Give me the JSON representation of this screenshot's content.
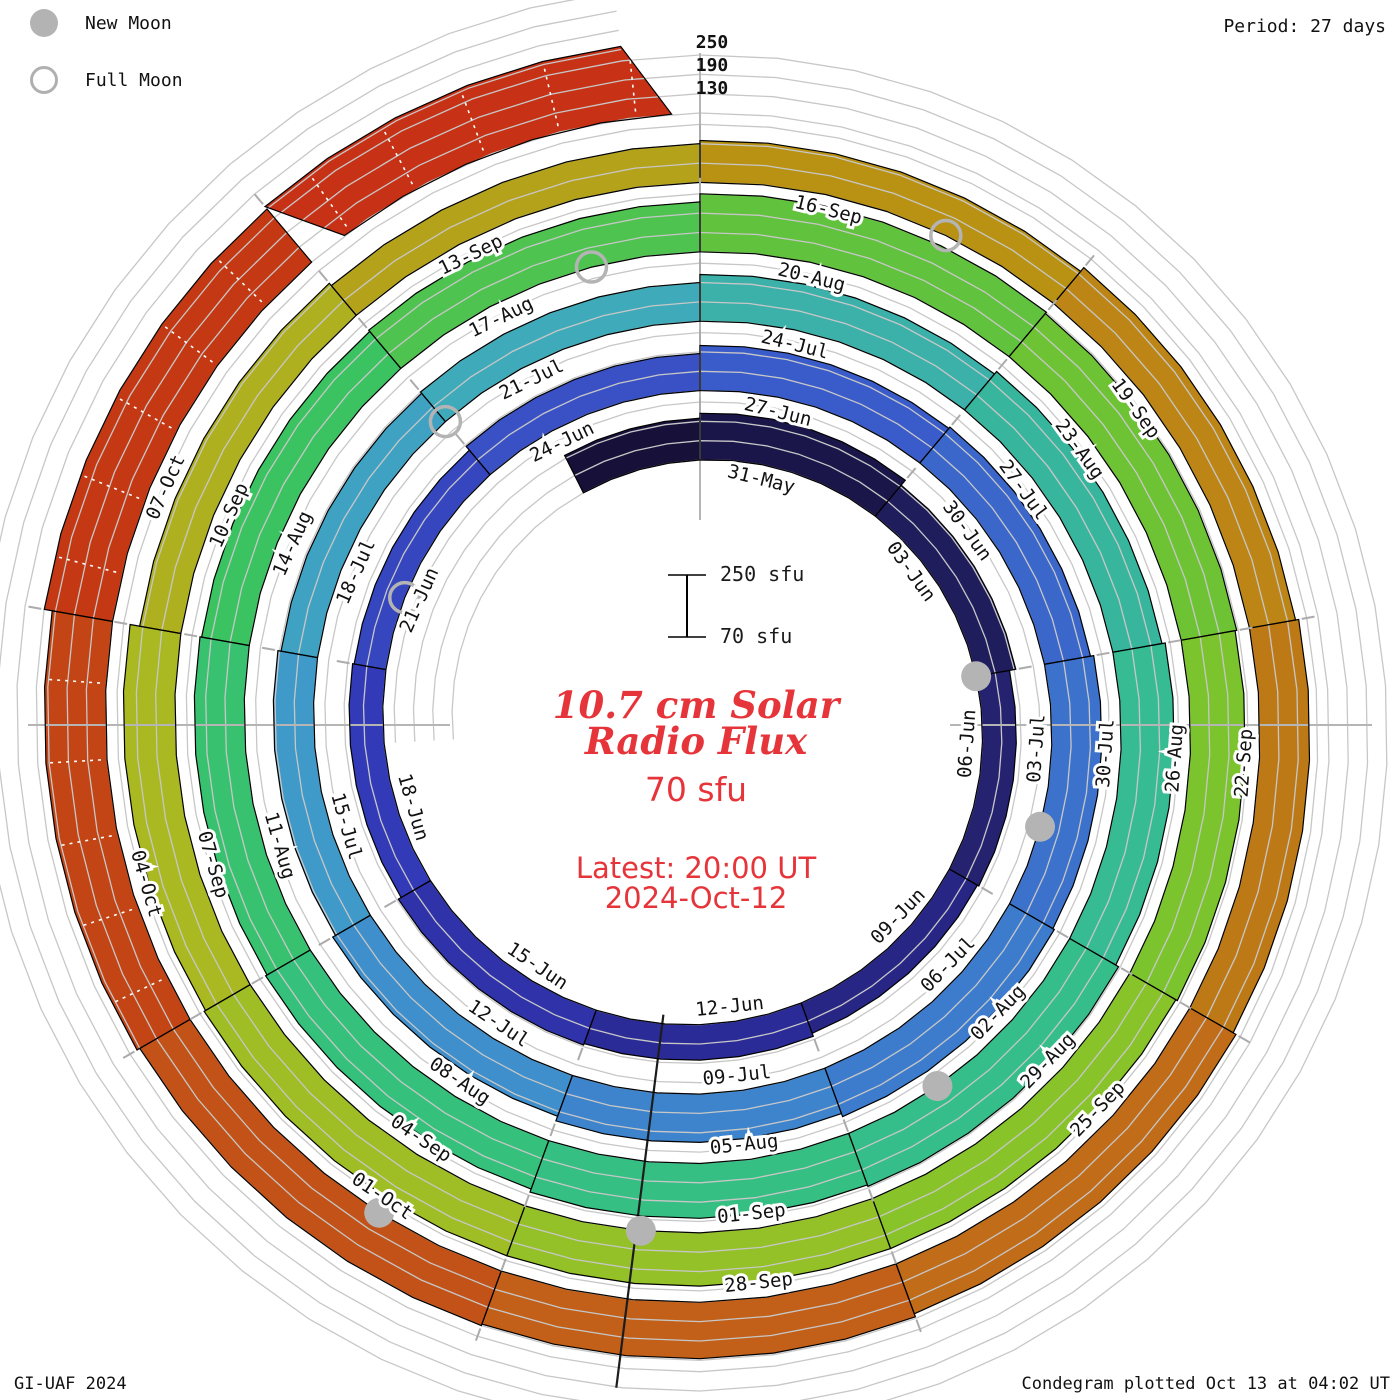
{
  "legend": {
    "items": [
      {
        "id": "new-moon",
        "label": "New Moon"
      },
      {
        "id": "full-moon",
        "label": "Full Moon"
      }
    ]
  },
  "period_label": "Period: 27 days",
  "footer": {
    "left": "GI-UAF 2024",
    "right": "Condegram plotted Oct 13 at 04:02 UT"
  },
  "center_text": {
    "title_line1": "10.7 cm Solar",
    "title_line2": "Radio Flux",
    "baseline_label": "70 sfu",
    "latest_line1": "Latest: 20:00 UT",
    "latest_line2": "2024-Oct-12",
    "color": "#e6353a"
  },
  "scale_bar": {
    "top_label": "250 sfu",
    "bottom_label": "70 sfu"
  },
  "end_axis_labels": [
    "250",
    "190",
    "130"
  ],
  "chart_data": {
    "type": "spiral-condegram-bar",
    "title": "10.7 cm Solar Radio Flux",
    "flux_unit": "sfu",
    "period_days": 27,
    "start_date": "2024-05-29",
    "end_date_label": "2024-Oct-12",
    "latest_time": "20:00 UT",
    "anchor_top_date": "31-May",
    "baseline_sfu": 70,
    "grid_levels_sfu": [
      130,
      190,
      250
    ],
    "end_day": 136.8,
    "segments": [
      {
        "d": 0,
        "label": "",
        "flux": 200
      },
      {
        "d": 2,
        "label": "31-May",
        "flux": 215
      },
      {
        "d": 5,
        "label": "03-Jun",
        "flux": 195
      },
      {
        "d": 8,
        "label": "06-Jun",
        "flux": 175
      },
      {
        "d": 11,
        "label": "09-Jun",
        "flux": 170
      },
      {
        "d": 14,
        "label": "12-Jun",
        "flux": 180
      },
      {
        "d": 17,
        "label": "15-Jun",
        "flux": 185
      },
      {
        "d": 20,
        "label": "18-Jun",
        "flux": 175
      },
      {
        "d": 23,
        "label": "21-Jun",
        "flux": 170
      },
      {
        "d": 26,
        "label": "24-Jun",
        "flux": 185
      },
      {
        "d": 29,
        "label": "27-Jun",
        "flux": 210
      },
      {
        "d": 32,
        "label": "30-Jun",
        "flux": 215
      },
      {
        "d": 35,
        "label": "03-Jul",
        "flux": 225
      },
      {
        "d": 38,
        "label": "06-Jul",
        "flux": 230
      },
      {
        "d": 41,
        "label": "09-Jul",
        "flux": 220
      },
      {
        "d": 44,
        "label": "12-Jul",
        "flux": 205
      },
      {
        "d": 47,
        "label": "15-Jul",
        "flux": 195
      },
      {
        "d": 50,
        "label": "18-Jul",
        "flux": 185
      },
      {
        "d": 53,
        "label": "21-Jul",
        "flux": 190
      },
      {
        "d": 56,
        "label": "24-Jul",
        "flux": 215
      },
      {
        "d": 59,
        "label": "27-Jul",
        "flux": 225
      },
      {
        "d": 62,
        "label": "30-Jul",
        "flux": 235
      },
      {
        "d": 65,
        "label": "02-Aug",
        "flux": 245
      },
      {
        "d": 68,
        "label": "05-Aug",
        "flux": 240
      },
      {
        "d": 71,
        "label": "08-Aug",
        "flux": 230
      },
      {
        "d": 74,
        "label": "11-Aug",
        "flux": 225
      },
      {
        "d": 77,
        "label": "14-Aug",
        "flux": 220
      },
      {
        "d": 80,
        "label": "17-Aug",
        "flux": 225
      },
      {
        "d": 83,
        "label": "20-Aug",
        "flux": 250
      },
      {
        "d": 86,
        "label": "23-Aug",
        "flux": 245
      },
      {
        "d": 89,
        "label": "26-Aug",
        "flux": 240
      },
      {
        "d": 92,
        "label": "29-Aug",
        "flux": 235
      },
      {
        "d": 95,
        "label": "01-Sep",
        "flux": 235
      },
      {
        "d": 98,
        "label": "04-Sep",
        "flux": 235
      },
      {
        "d": 101,
        "label": "07-Sep",
        "flux": 230
      },
      {
        "d": 104,
        "label": "10-Sep",
        "flux": 200
      },
      {
        "d": 107,
        "label": "13-Sep",
        "flux": 190
      },
      {
        "d": 110,
        "label": "16-Sep",
        "flux": 200
      },
      {
        "d": 113,
        "label": "19-Sep",
        "flux": 215
      },
      {
        "d": 116,
        "label": "22-Sep",
        "flux": 225
      },
      {
        "d": 119,
        "label": "25-Sep",
        "flux": 235
      },
      {
        "d": 122,
        "label": "28-Sep",
        "flux": 245
      },
      {
        "d": 125,
        "label": "01-Oct",
        "flux": 250
      },
      {
        "d": 128,
        "label": "04-Oct",
        "flux": 260,
        "hatched": true
      },
      {
        "d": 131,
        "label": "07-Oct",
        "flux": 285,
        "hatched": true
      },
      {
        "d": 134,
        "label": "",
        "flux": 295,
        "hatched": true
      }
    ],
    "moons": {
      "new": [
        {
          "d": 8,
          "date": "06-Jun"
        },
        {
          "d": 37,
          "date": "05-Jul"
        },
        {
          "d": 67,
          "date": "04-Aug"
        },
        {
          "d": 97,
          "date": "03-Sep"
        },
        {
          "d": 126,
          "date": "02-Oct"
        }
      ],
      "full": [
        {
          "d": 24,
          "date": "22-Jun"
        },
        {
          "d": 53,
          "date": "21-Jul"
        },
        {
          "d": 82,
          "date": "19-Aug"
        },
        {
          "d": 112,
          "date": "18-Sep"
        }
      ]
    },
    "colormap": [
      [
        0,
        "#150f34"
      ],
      [
        8,
        "#232066"
      ],
      [
        15,
        "#2a2a94"
      ],
      [
        21,
        "#3338b6"
      ],
      [
        29,
        "#3a57c9"
      ],
      [
        36,
        "#3c70cc"
      ],
      [
        43,
        "#3e86cd"
      ],
      [
        49,
        "#3f9bc9"
      ],
      [
        54,
        "#3fa9bd"
      ],
      [
        59,
        "#39b4a2"
      ],
      [
        65,
        "#36bd8e"
      ],
      [
        73,
        "#35c17b"
      ],
      [
        79,
        "#3dc35f"
      ],
      [
        84,
        "#5fc23e"
      ],
      [
        90,
        "#79c42e"
      ],
      [
        96,
        "#92c227"
      ],
      [
        102,
        "#a9ba21"
      ],
      [
        107,
        "#b2ab20"
      ],
      [
        111,
        "#b99413"
      ],
      [
        116,
        "#bd7f16"
      ],
      [
        121,
        "#c16a19"
      ],
      [
        126,
        "#c25417"
      ],
      [
        131,
        "#c33d13"
      ],
      [
        137,
        "#c82d16"
      ]
    ],
    "layout": {
      "cx": 700,
      "cy": 725,
      "r0": 265,
      "step_per_rotation": 69.4,
      "px_per_sfu": 0.3222,
      "grid_color": "#c7c7c7",
      "moon_color": "#b4b4b4",
      "label_color": "#111111",
      "seam_angle_deg": 187.2
    }
  }
}
